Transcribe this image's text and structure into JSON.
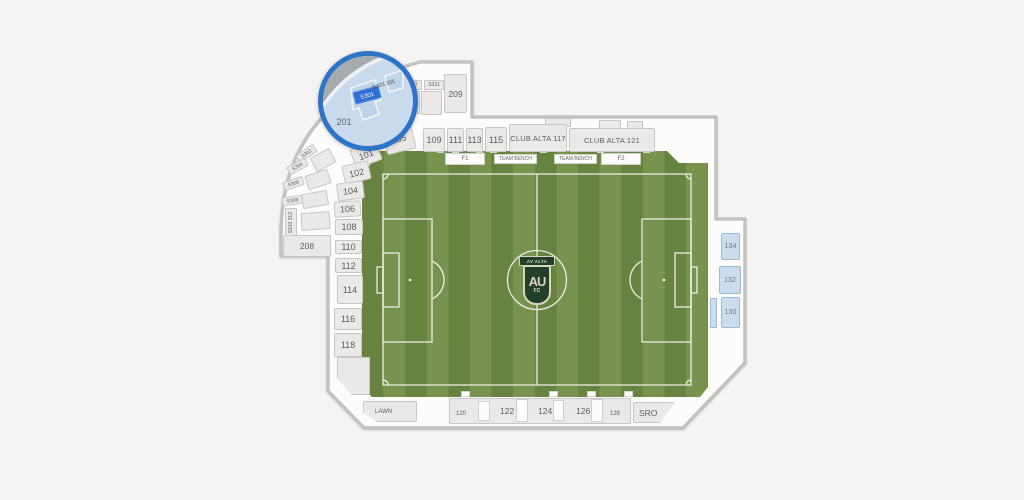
{
  "colors": {
    "accent_blue": "#2d73c6",
    "section_fill": "#eae9e8",
    "highlight_section_fill": "#cbdcec",
    "grass_dark": "#68823f",
    "grass_light": "#79924e",
    "crest_green": "#243f2c",
    "crest_cream": "#d9d5bb"
  },
  "magnifier": {
    "highlight": "S301",
    "label_201": "201",
    "label_303_305": "S303 305"
  },
  "sections": {
    "top": [
      "105",
      "109",
      "111",
      "113",
      "115",
      "CLUB ALTA 117",
      "CLUB ALTA 121"
    ],
    "left": [
      "101",
      "102",
      "104",
      "106",
      "108",
      "110",
      "112",
      "114",
      "116",
      "118"
    ],
    "left_terrace": [
      "S302",
      "S304",
      "S306",
      "S308",
      "S310 312"
    ],
    "upper": {
      "s307": "S307",
      "s311": "S311",
      "s209": "209",
      "s208": "208"
    },
    "right": [
      "134",
      "132",
      "130"
    ],
    "bottom": {
      "lawn": "LAWN",
      "row": [
        "120",
        "122",
        "124",
        "126",
        "128"
      ],
      "sro": "SRO"
    }
  },
  "field": {
    "labels": [
      "F1",
      "TEAM BENCH",
      "TEAM BENCH",
      "F2"
    ],
    "crest": {
      "banner": "AV ALTA",
      "monogram": "AU",
      "footer": "FC"
    }
  }
}
